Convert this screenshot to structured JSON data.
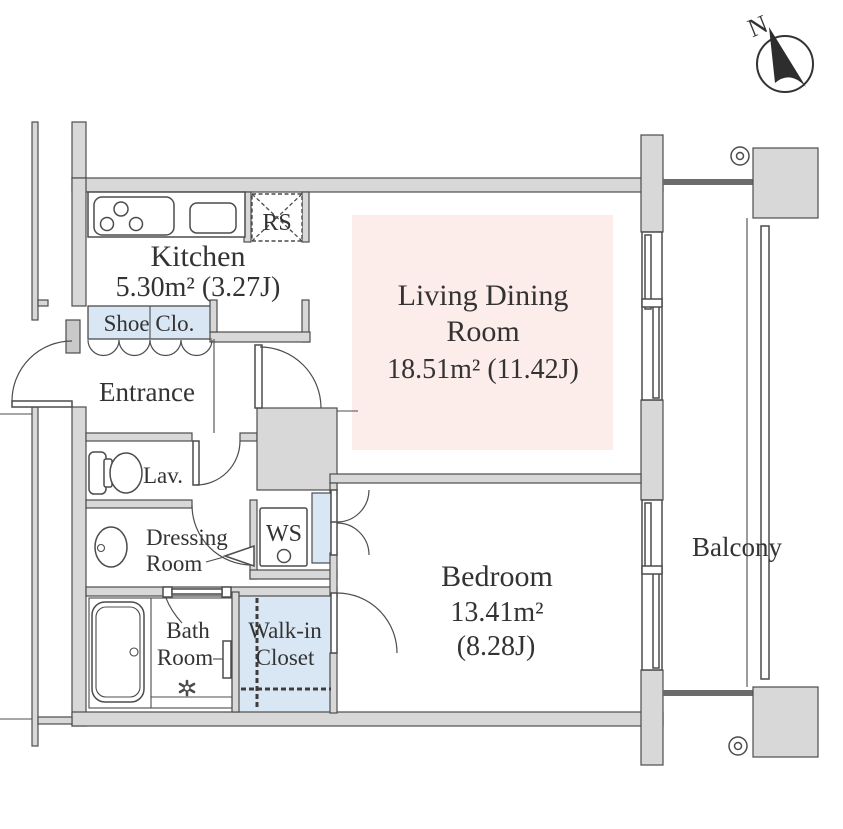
{
  "plan": {
    "compass_label": "N",
    "rooms": {
      "kitchen": {
        "name": "Kitchen",
        "area": "5.30m² (3.27J)"
      },
      "living_dining": {
        "line1": "Living Dining",
        "line2": "Room",
        "area": "18.51m² (11.42J)"
      },
      "bedroom": {
        "name": "Bedroom",
        "area_value": "13.41m²",
        "area_jo": "(8.28J)"
      },
      "balcony": {
        "name": "Balcony"
      },
      "entrance": {
        "name": "Entrance"
      },
      "lavatory": {
        "name": "Lav."
      },
      "dressing_room": {
        "line1": "Dressing",
        "line2": "Room"
      },
      "washing_space": {
        "name": "WS"
      },
      "bath_room": {
        "line1": "Bath",
        "line2": "Room"
      },
      "walk_in_closet": {
        "line1": "Walk-in",
        "line2": "Closet"
      },
      "shoe_closet": {
        "name": "Shoe Clo."
      },
      "refrigerator_space": {
        "name": "RS"
      }
    },
    "colors": {
      "wall_fill": "#d8d8d8",
      "line": "#4c4c4c",
      "living_dining_floor": "#fcecea",
      "closet_blue": "#d9e7f4",
      "text": "#333333"
    }
  }
}
